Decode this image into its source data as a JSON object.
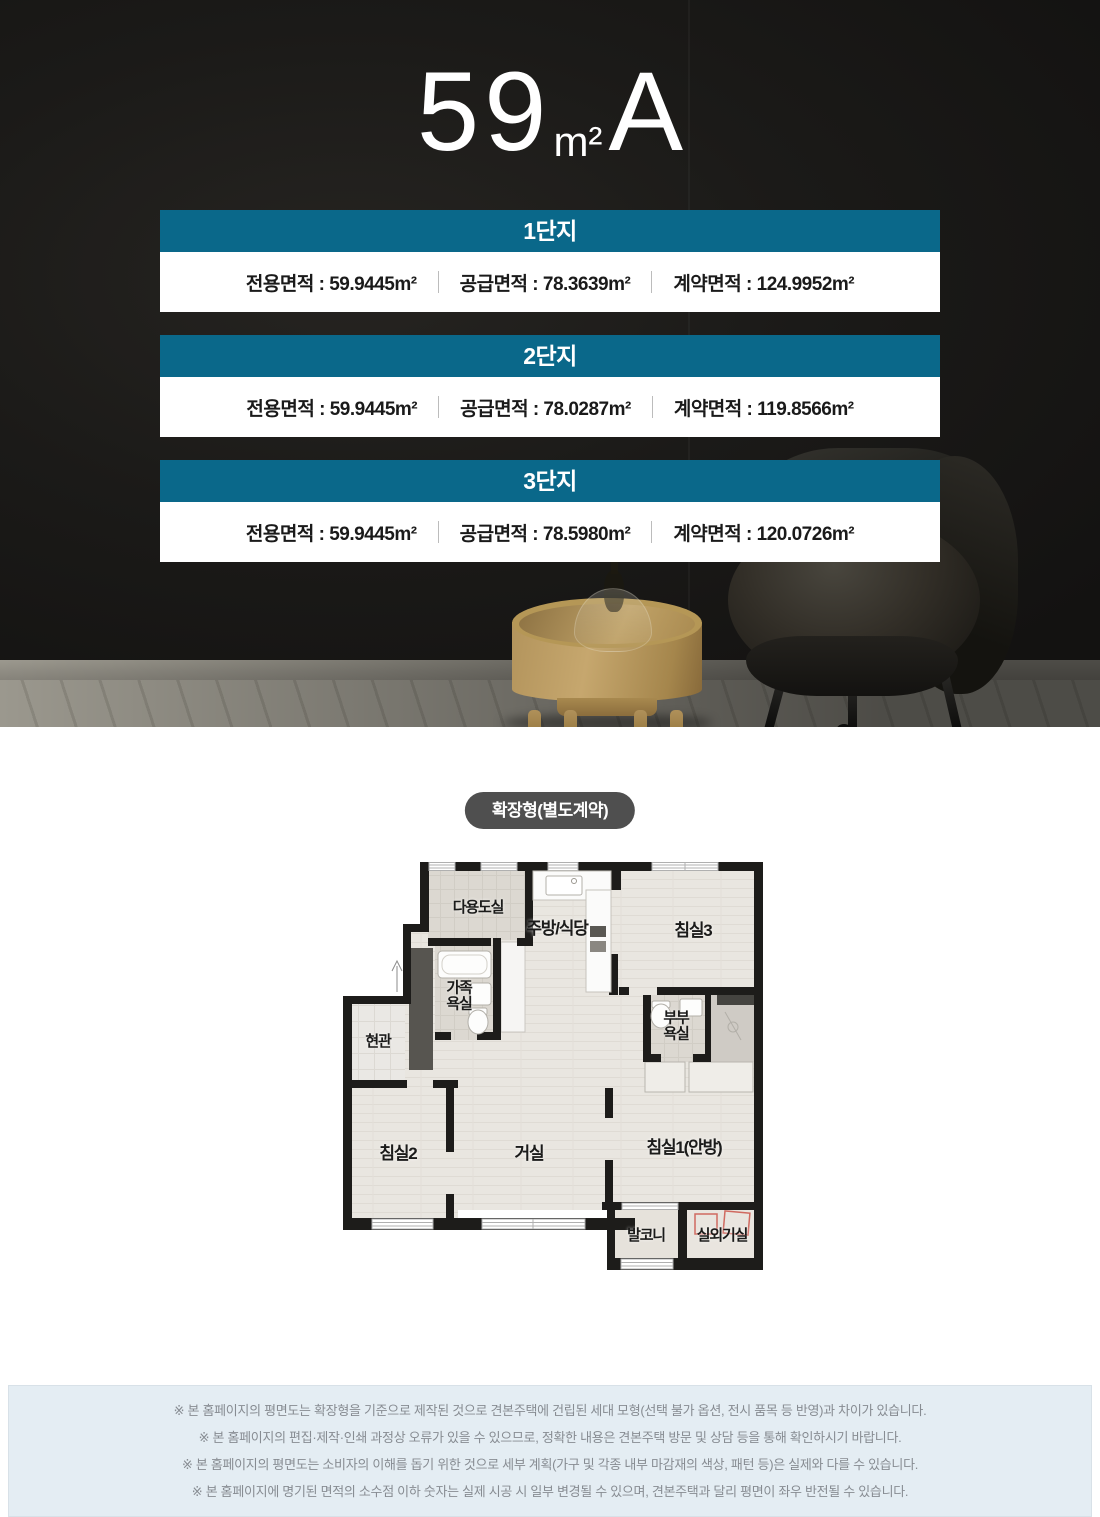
{
  "title": {
    "size": "59",
    "unit": "m²",
    "type": "A"
  },
  "complexes": [
    {
      "name": "1단지",
      "specs": [
        "전용면적 : 59.9445m²",
        "공급면적 : 78.3639m²",
        "계약면적 : 124.9952m²"
      ]
    },
    {
      "name": "2단지",
      "specs": [
        "전용면적 : 59.9445m²",
        "공급면적 : 78.0287m²",
        "계약면적 : 119.8566m²"
      ]
    },
    {
      "name": "3단지",
      "specs": [
        "전용면적 : 59.9445m²",
        "공급면적 : 78.5980m²",
        "계약면적 : 120.0726m²"
      ]
    }
  ],
  "plan": {
    "badge": "확장형(별도계약)",
    "rooms": {
      "utility": "다용도실",
      "kitchen": "주방/식당",
      "bedroom3": "침실3",
      "family_bath": "가족욕실",
      "entrance": "현관",
      "master_bath": "부부욕실",
      "bedroom2": "침실2",
      "living": "거실",
      "bedroom1": "침실1(안방)",
      "balcony": "발코니",
      "ac_room": "실외기실"
    }
  },
  "disclaimers": [
    "※ 본 홈페이지의 평면도는 확장형을 기준으로 제작된 것으로 견본주택에 건립된 세대 모형(선택 불가 옵션, 전시 품목 등 반영)과 차이가 있습니다.",
    "※ 본 홈페이지의 편집·제작·인쇄 과정상 오류가 있을 수 있으므로, 정확한 내용은 견본주택 방문 및 상담 등을 통해 확인하시기 바랍니다.",
    "※ 본 홈페이지의 평면도는 소비자의 이해를 돕기 위한 것으로 세부 계획(가구 및 각종 내부 마감재의 색상, 패턴 등)은 실제와 다를 수 있습니다.",
    "※ 본 홈페이지에 명기된 면적의 소수점 이하 숫자는 실제 시공 시 일부 변경될 수 있으며, 견본주택과 달리 평면이 좌우 반전될 수 있습니다."
  ],
  "colors": {
    "accent_teal": "#0a688a",
    "badge_gray": "#4f4f4f",
    "footer_bg": "#e4edf3"
  }
}
